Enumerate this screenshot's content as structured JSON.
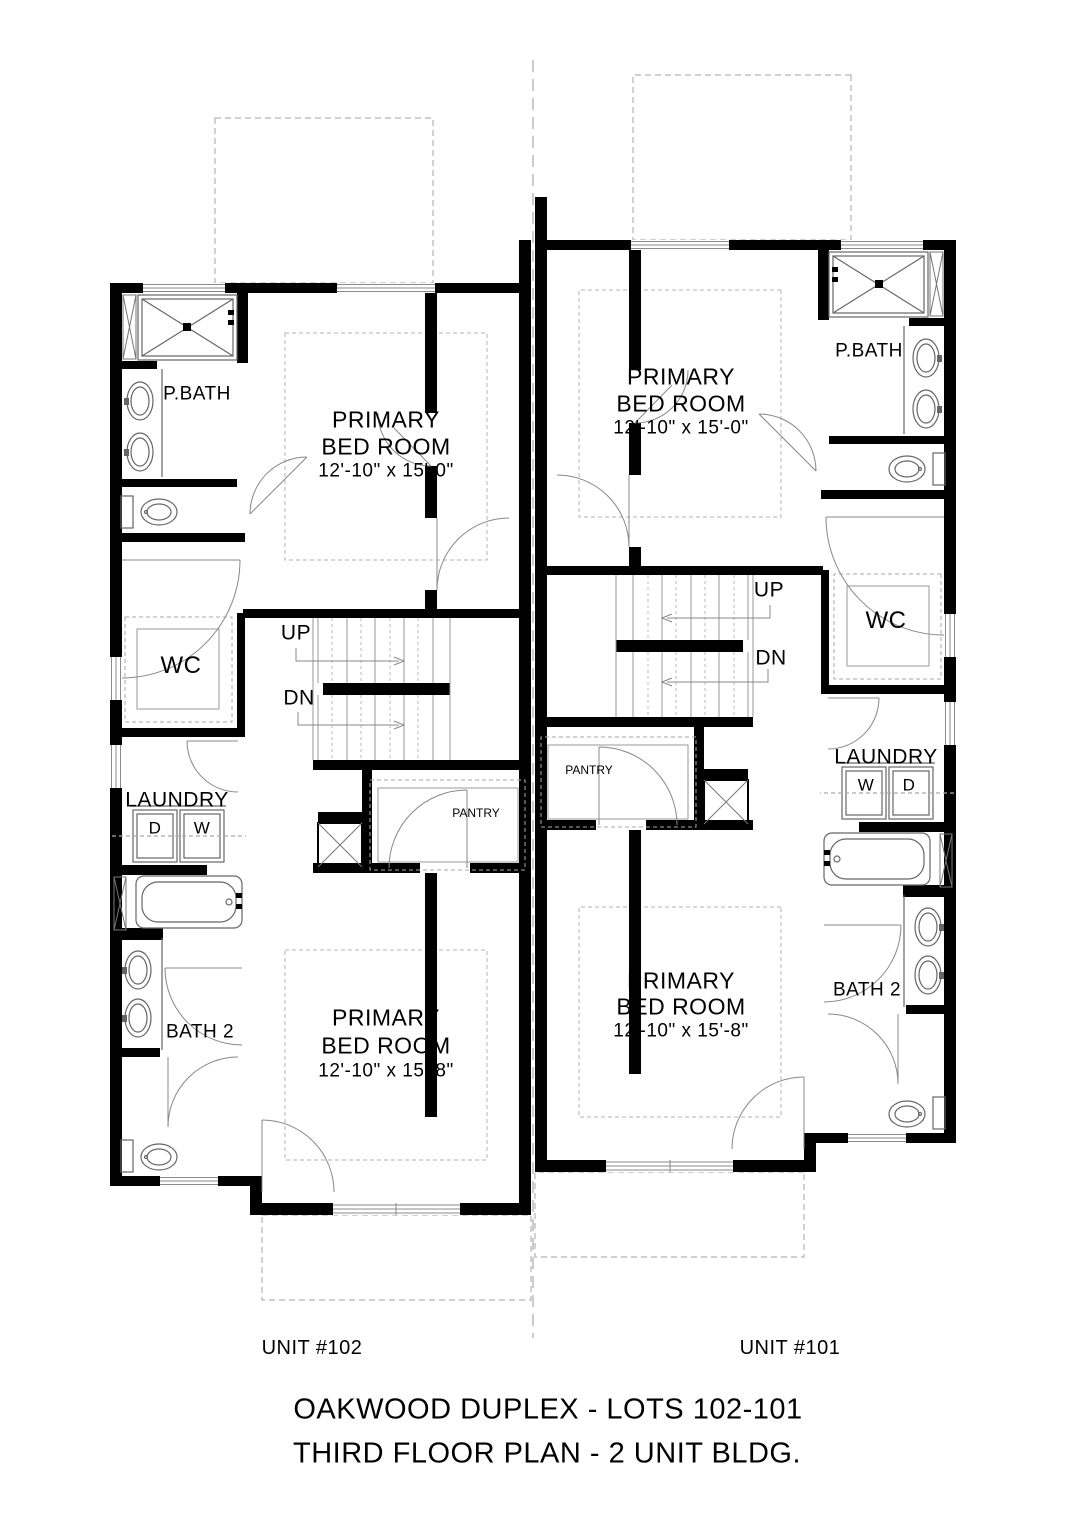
{
  "title": {
    "line1": "OAKWOOD DUPLEX - LOTS 102-101",
    "line2": "THIRD FLOOR PLAN - 2 UNIT BLDG."
  },
  "unit102": {
    "name": "UNIT #102",
    "primary_bed_1": {
      "line1": "PRIMARY",
      "line2": "BED ROOM",
      "dims": "12'-10\" x 15'-0\""
    },
    "primary_bed_2": {
      "line1": "PRIMARY",
      "line2": "BED ROOM",
      "dims": "12'-10\" x 15'-8\""
    },
    "pbath": "P.BATH",
    "wc": "WC",
    "laundry": "LAUNDRY",
    "washer": "W",
    "dryer": "D",
    "pantry": "PANTRY",
    "bath2": "BATH 2",
    "up": "UP",
    "dn": "DN"
  },
  "unit101": {
    "name": "UNIT #101",
    "primary_bed_1": {
      "line1": "PRIMARY",
      "line2": "BED ROOM",
      "dims": "12'-10\" x 15'-0\""
    },
    "primary_bed_2": {
      "line1": "PRIMARY",
      "line2": "BED ROOM",
      "dims": "12'-10\" x 15'-8\""
    },
    "pbath": "P.BATH",
    "wc": "WC",
    "laundry": "LAUNDRY",
    "washer": "W",
    "dryer": "D",
    "pantry": "PANTRY",
    "bath2": "BATH 2",
    "up": "UP",
    "dn": "DN"
  },
  "colors": {
    "wall": "#000000",
    "fixture": "#666666",
    "dash": "#aaaaaa"
  }
}
